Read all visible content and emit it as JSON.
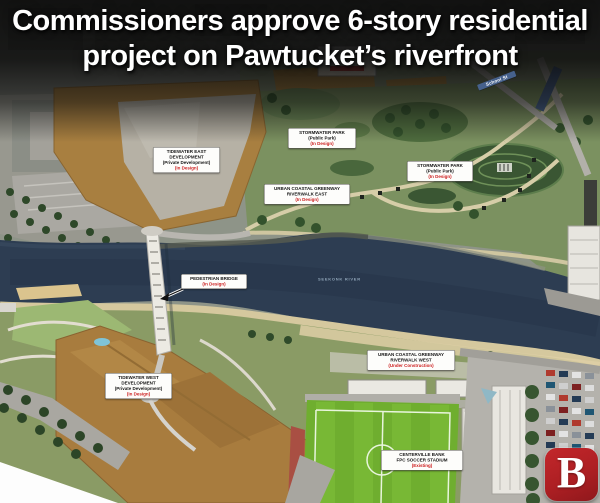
{
  "headline": {
    "text": "Commissioners approve 6-story residential project on Pawtucket’s riverfront"
  },
  "logo": {
    "letter": "B",
    "background_color": "#b01f24",
    "letter_color": "#ffffff"
  },
  "map": {
    "river_name": "SEEKONK RIVER",
    "street_label": "School St",
    "label_status_color": "#cc1c1c",
    "water_color": "#2d3d52",
    "labels": [
      {
        "id": "tidewater-east",
        "lines": [
          "TIDEWATER EAST",
          "DEVELOPMENT",
          "(Private Development)"
        ],
        "status": "(In Design)"
      },
      {
        "id": "stormwater-park-west",
        "lines": [
          "STORMWATER PARK",
          "(Public Park)"
        ],
        "status": "(In Design)"
      },
      {
        "id": "stormwater-park-east",
        "lines": [
          "STORMWATER PARK",
          "(Public Park)"
        ],
        "status": "(In Design)"
      },
      {
        "id": "riverwalk-east",
        "lines": [
          "URBAN COASTAL GREENWAY",
          "RIVERWALK EAST"
        ],
        "status": "(In Design)"
      },
      {
        "id": "pedestrian-bridge",
        "lines": [
          "PEDESTRIAN BRIDGE"
        ],
        "status": "(In Design)"
      },
      {
        "id": "tidewater-west",
        "lines": [
          "TIDEWATER WEST",
          "DEVELOPMENT",
          "(Private Development)"
        ],
        "status": "(In Design)"
      },
      {
        "id": "riverwalk-west",
        "lines": [
          "URBAN COASTAL GREENWAY",
          "RIVERWALK WEST"
        ],
        "status": "(Under Construction)"
      },
      {
        "id": "soccer-stadium",
        "lines": [
          "CENTERVILLE BANK",
          "FPC SOCCER STADIUM"
        ],
        "status": "(Existing)"
      }
    ]
  }
}
